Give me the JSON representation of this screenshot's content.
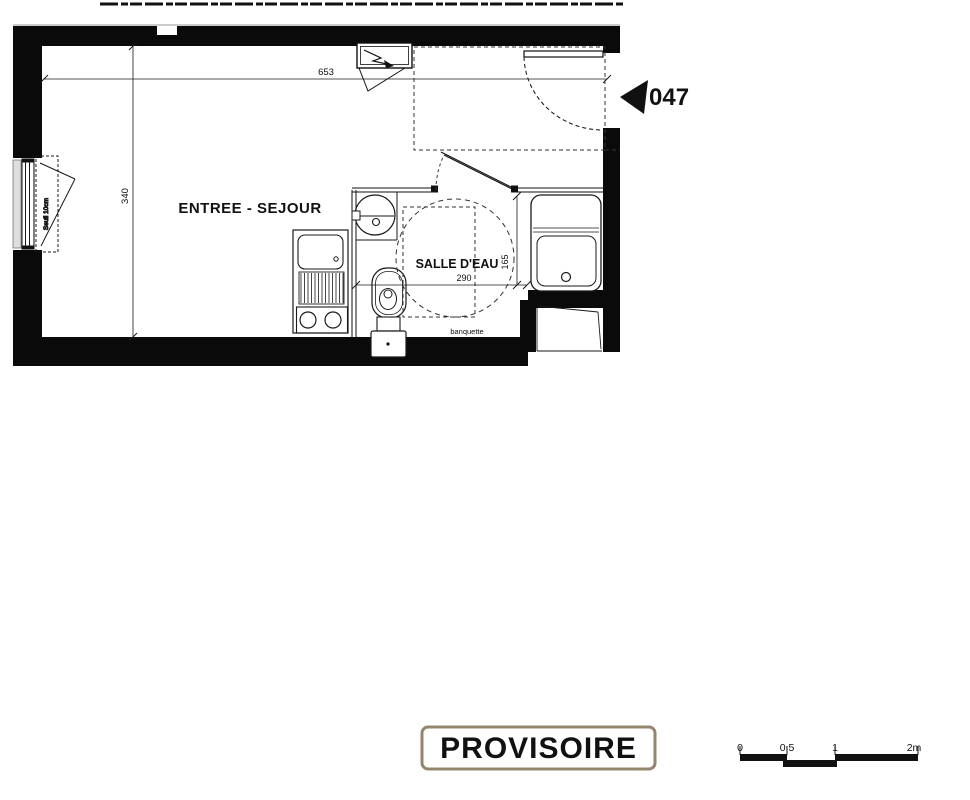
{
  "plan": {
    "unit_number": "047",
    "room_label": "ENTREE - SEJOUR",
    "bathroom_label": "SALLE D'EAU",
    "banquette_label": "banquette",
    "threshold_label": "Seuil 10cm",
    "dim_top": "653",
    "dim_left": "340",
    "dim_bathroom_width": "290",
    "dim_bathroom_depth": "165"
  },
  "stamp": {
    "label": "PROVISOIRE"
  },
  "scale_bar": {
    "labels": [
      "0",
      "0,5",
      "1",
      "2m"
    ]
  },
  "colors": {
    "wall": "#0a0a0a",
    "line": "#1a1a1a",
    "stamp_border": "#94856f",
    "stamp_text": "#26120b",
    "threshold_text": "#8a3b3b",
    "window_sill": "#dedede"
  }
}
